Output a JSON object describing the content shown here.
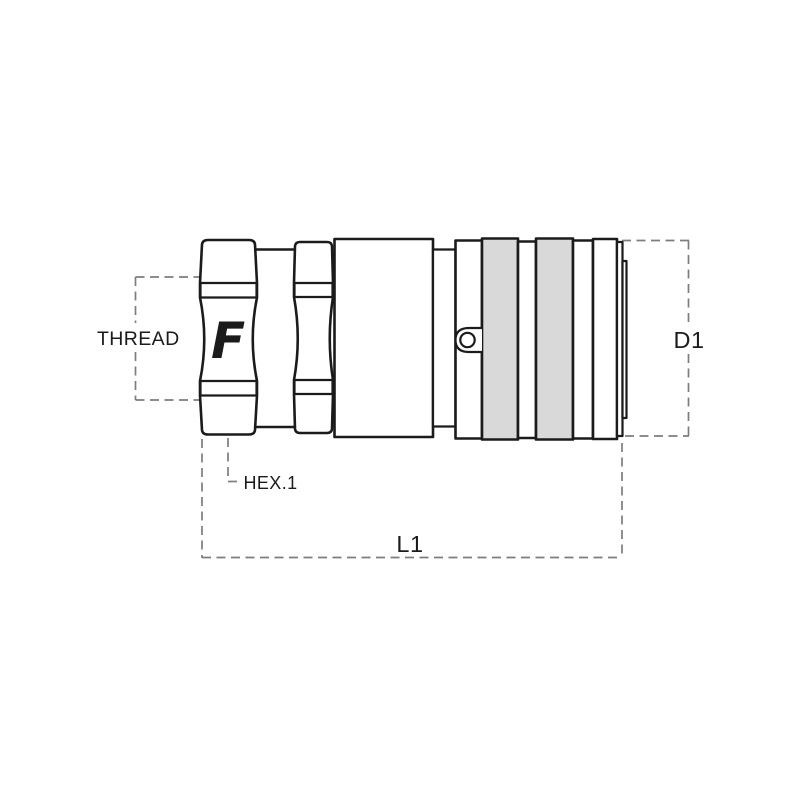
{
  "drawing": {
    "title": "coupling-dimension-drawing",
    "logo": "F",
    "labels": {
      "thread": "THREAD",
      "hex1": "HEX.1",
      "length": "L1",
      "diameter": "D1"
    },
    "colors": {
      "line": "#1b1b1b",
      "band_fill": "#d9d9d9",
      "dash": "#7d7d7d",
      "background": "#ffffff",
      "logo": "#1b1b1b"
    }
  }
}
